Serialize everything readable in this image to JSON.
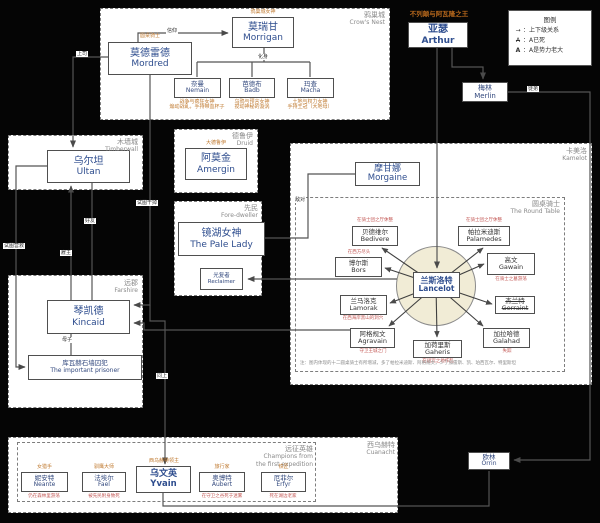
{
  "legend": {
    "title": "图例",
    "rows": [
      {
        "symbol": "→",
        "text": "：上下级关系"
      },
      {
        "symbol": "A",
        "text": "：A已死"
      },
      {
        "symbol": "A",
        "text": "：A是势力老大"
      }
    ]
  },
  "regions": {
    "crows_nest": {
      "cn": "鸦巢城",
      "en": "Crow's Nest"
    },
    "timberwall": {
      "cn": "木墙城",
      "en": "Timberwall"
    },
    "druid": {
      "cn": "德鲁伊",
      "en": "Druid"
    },
    "fore_dweller": {
      "cn": "先民",
      "en": "Fore-dweller"
    },
    "farshire": {
      "cn": "远郡",
      "en": "Farshire"
    },
    "kamelot": {
      "cn": "卡美洛",
      "en": "Kamelot"
    },
    "round_table": {
      "cn": "圆桌骑士",
      "en": "The Round Table"
    },
    "cuanacht": {
      "cn": "西乌赫特",
      "en": "Cuanacht"
    },
    "champions": {
      "cn": "远征英雄",
      "en1": "Champions from",
      "en2": "the first expedition"
    }
  },
  "characters": {
    "mordred": {
      "cn": "莫德雷德",
      "en": "Mordred",
      "tag": "圆桌骑士"
    },
    "morrigan": {
      "cn": "莫瑞甘",
      "en": "Morrigan",
      "tag": "鸦巢城女神"
    },
    "arthur": {
      "cn": "亚瑟",
      "en": "Arthur",
      "tag": "不列颠与阿瓦隆之王"
    },
    "merlin": {
      "cn": "梅林",
      "en": "Merlin"
    },
    "orrin": {
      "cn": "欧林",
      "en": "Orrin"
    },
    "ultan": {
      "cn": "乌尔坦",
      "en": "Ultan"
    },
    "kincaid": {
      "cn": "琴凯德",
      "en": "Kincaid"
    },
    "prisoner": {
      "cn": "库瓦赫石墙囚犯",
      "en": "The important prisoner"
    },
    "amergin": {
      "cn": "阿莫金",
      "en": "Amergin",
      "tag": "大德鲁伊"
    },
    "pale_lady": {
      "cn": "镜湖女神",
      "en": "The Pale Lady"
    },
    "reclaimer": {
      "cn": "光复者",
      "en": "Reclaimer"
    },
    "morgaine": {
      "cn": "摩甘娜",
      "en": "Morgaine"
    },
    "lancelot": {
      "cn": "兰斯洛特",
      "en": "Lancelot"
    },
    "yvain": {
      "cn": "乌文英",
      "en": "Yvain",
      "tag": "西乌赫特领主"
    }
  },
  "goddesses": [
    {
      "cn": "奈曼",
      "en": "Nemain",
      "desc1": "战争与疯狂女神",
      "desc2": "煽动战乱，手持带血杯子"
    },
    {
      "cn": "芭德布",
      "en": "Badb",
      "desc1": "乌鸦与预言女神",
      "desc2": "搅动神秘的漩涡"
    },
    {
      "cn": "玛查",
      "en": "Macha",
      "desc1": "土地与权力女神",
      "desc2": "手持王冠（大地母）"
    }
  ],
  "knights": [
    {
      "cn": "贝德维尔",
      "en": "Bedivere",
      "note": "在骑士团之厅休整"
    },
    {
      "cn": "帕拉米迪斯",
      "en": "Palamedes",
      "note": "在骑士团之厅休整"
    },
    {
      "cn": "博尔斯",
      "en": "Bors",
      "note": "在西方尽头"
    },
    {
      "cn": "高文",
      "en": "Gawain",
      "note": "在骑士之墓游荡"
    },
    {
      "cn": "兰马洛克",
      "en": "Lamorak",
      "note": "在西海岸黑山的洞穴"
    },
    {
      "cn": "杰兰特",
      "en": "Gerraint",
      "note": ""
    },
    {
      "cn": "阿格规文",
      "en": "Agravain",
      "note": "守卫王城之门"
    },
    {
      "cn": "加荷里斯",
      "en": "Gaheris",
      "note": "在诅咒之地作乱"
    },
    {
      "cn": "加拉哈德",
      "en": "Galahad",
      "note": "失踪"
    }
  ],
  "champions": [
    {
      "tag": "女猎手",
      "cn": "妮安特",
      "en": "Neante",
      "note": "仍在森林里游荡"
    },
    {
      "tag": "驯鹰大师",
      "cn": "法埃尔",
      "en": "Fael",
      "note": "被先民附身致死"
    },
    {
      "tag": "旅行家",
      "cn": "奥博特",
      "en": "Aubert",
      "note": "在守卫之谷死于迷雾"
    },
    {
      "tag": "铁匠",
      "cn": "厄菲尔",
      "en": "Erfyr",
      "note": "死在湖边老家"
    }
  ],
  "edge_labels": {
    "faith": "信仰",
    "avatar": "化身",
    "superior": "上司",
    "employer": "雇主",
    "friend": "好友",
    "rescue": "试图营救",
    "kill": "试图干掉",
    "ditto": "同上",
    "mother_son": "母子",
    "hostile": "敌对",
    "apprentice": "徒弟"
  },
  "footnote": "注：图内体现的十二圆桌骑士有所增减，多了帕拉米迪斯、阿格规文，少了加雷斯、凯、珀西瓦尔、特里斯坦"
}
